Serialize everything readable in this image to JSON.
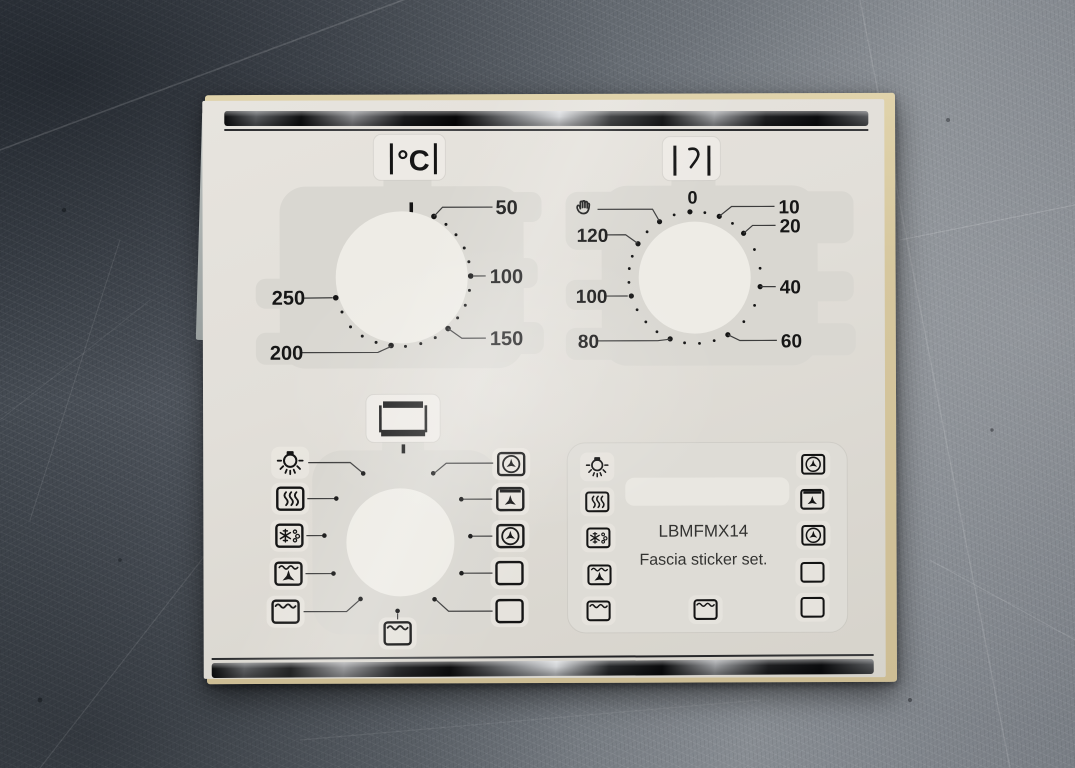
{
  "sheet": {
    "temperature_dial": {
      "unit_symbol": "°C",
      "labels": [
        "50",
        "100",
        "150",
        "200",
        "250"
      ]
    },
    "timer_dial": {
      "labels": [
        "0",
        "10",
        "20",
        "40",
        "60",
        "80",
        "100",
        "120"
      ],
      "icons": [
        "hand-icon",
        "minute-minder-icon"
      ]
    },
    "function_dial": {
      "top_icon": "oven-icon",
      "left_icons": [
        "oven-light-icon",
        "grill-icon",
        "defrost-icon",
        "fan-grill-icon",
        "top-heat-icon"
      ],
      "right_icons": [
        "fan-oven-icon",
        "fan-top-heat-icon",
        "fan-oven-icon",
        "blank-box-icon",
        "blank-box-icon"
      ],
      "bottom_icon": "top-heat-icon"
    },
    "info_panel": {
      "model_text": "LBMFMX14",
      "subtitle_text": "Fascia sticker set.",
      "left_icons": [
        "oven-light-icon",
        "grill-icon",
        "defrost-icon",
        "fan-grill-icon",
        "top-heat-icon"
      ],
      "right_icons": [
        "fan-oven-icon",
        "fan-top-heat-icon",
        "fan-oven-icon",
        "blank-box-icon",
        "blank-box-icon"
      ],
      "bottom_icon": "top-heat-icon"
    },
    "icon_glyphs": {
      "oven-light-icon": "bulb-with-rays",
      "grill-icon": "three-wavy-lines-in-box",
      "defrost-icon": "snowflake-and-droplets-in-box",
      "fan-grill-icon": "wavy-line-over-fan-in-box",
      "top-heat-icon": "wavy-line-in-box",
      "fan-oven-icon": "fan-in-circle-in-box",
      "fan-top-heat-icon": "bar-over-fan-in-box",
      "blank-box-icon": "empty-box",
      "hand-icon": "open-palm",
      "minute-minder-icon": "curve-between-bars",
      "oven-icon": "rectangle-thick-top-bottom"
    }
  },
  "colors": {
    "sheet": "#e2dfd9",
    "ink": "#161616",
    "chrome_dark": "#0b0c0d",
    "chrome_light": "#d2d4d7",
    "metal_background": "#646a71",
    "backing_paper": "#d6c79e"
  }
}
